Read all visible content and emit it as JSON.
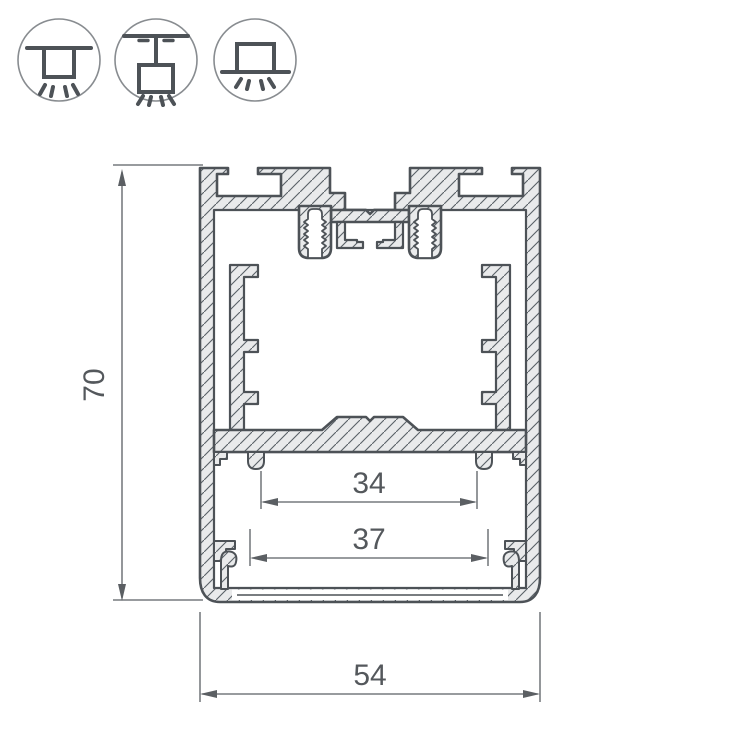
{
  "drawing": {
    "dimensions": {
      "height": "70",
      "inner_width_small": "34",
      "inner_width_large": "37",
      "outer_width": "54"
    },
    "icons": [
      {
        "name": "ceiling-mount-icon"
      },
      {
        "name": "suspended-mount-icon"
      },
      {
        "name": "surface-mount-icon"
      }
    ],
    "colors": {
      "outline": "#4d5257",
      "material_fill": "#e9eaeb",
      "dimension_line": "#5b5f63",
      "dimension_text": "#54585c",
      "icon_circle": "#888c90",
      "background": "#ffffff"
    }
  }
}
